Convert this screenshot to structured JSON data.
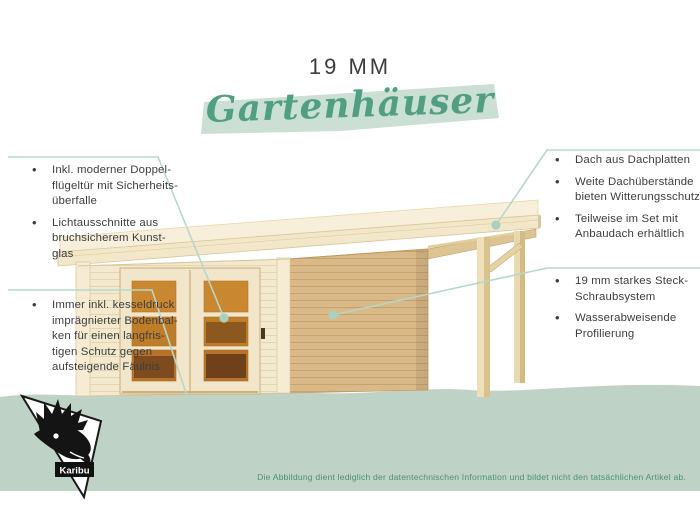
{
  "header": {
    "subtitle": "19 MM",
    "title": "Gartenhäuser"
  },
  "callouts": {
    "left_top": {
      "items": [
        "Inkl. moderner Doppel-\nflügeltür mit Sicherheits-\nüberfalle",
        "Lichtausschnitte aus\nbruchsicherem Kunst-\nglas"
      ]
    },
    "left_bottom": {
      "items": [
        "Immer inkl. kesseldruck\nimprägnierter Bodenbal-\nken für einen langfris-\ntigen Schutz gegen\naufsteigende Fäulnis"
      ]
    },
    "right_top": {
      "items": [
        "Dach aus Dachplatten",
        "Weite Dachüberstände\nbieten Witterungsschutz",
        "Teilweise im Set mit\nAnbaudach erhältlich"
      ]
    },
    "right_bottom": {
      "items": [
        "19 mm starkes Steck-\nSchraubsystem",
        "Wasserabweisende\nProfilierung"
      ]
    }
  },
  "illustration": {
    "description": "Wooden flat-roof garden house with glazed double door and attached side canopy (Anbaudach)"
  },
  "footer": {
    "logo_label": "Karibu",
    "disclaimer": "Die Abbildung dient lediglich der datentechnischen Information und bildet nicht den tatsächlichen Artikel ab."
  },
  "colors": {
    "accent_green": "#4fa083",
    "highlight_mint": "#cbdfd4",
    "band_green": "#bed3c6",
    "callout_line": "#b7d7cb",
    "text_dark": "#3d3d3d",
    "disclaimer_green": "#4e8f73",
    "wood_light": "#f2e7c9",
    "wood_side": "#d8b987",
    "glass_amber": "#c8862f"
  }
}
